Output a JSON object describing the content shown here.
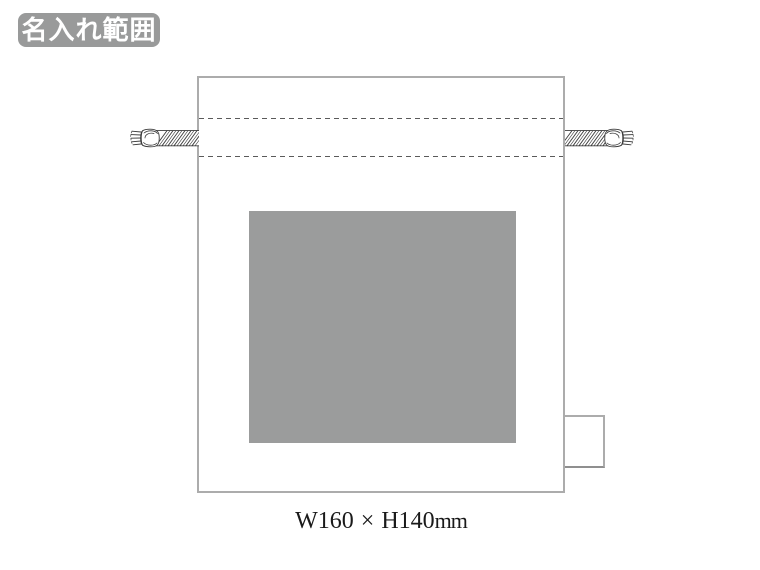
{
  "badge": {
    "label": "名入れ範囲"
  },
  "dimensions": {
    "width": "W160",
    "separator": "×",
    "height": "H140",
    "unit": "mm"
  },
  "icons": {
    "left_cord": "drawstring-cord-icon",
    "right_cord": "drawstring-cord-icon"
  },
  "colors": {
    "badge_bg": "#999a9a",
    "badge_text": "#ffffff",
    "bag_border": "#acacac",
    "bag_fill": "#ffffff",
    "channel_dash": "#5a5a5a",
    "print_area_fill": "#9b9c9c",
    "cord_stroke": "#3c3c3c",
    "tag_border_dark": "#8f8f8f",
    "dimension_text": "#1a1a1a"
  }
}
